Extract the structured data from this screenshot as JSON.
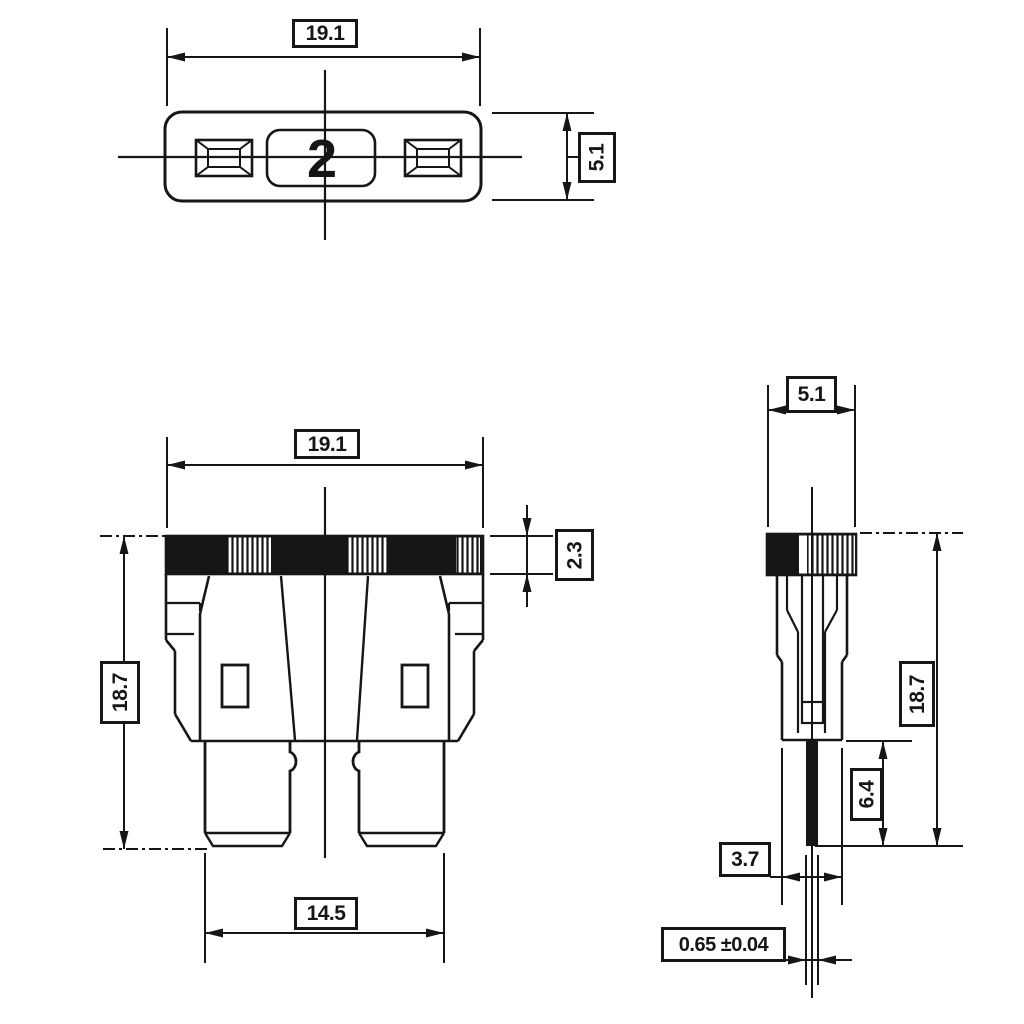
{
  "colors": {
    "background": "#ffffff",
    "ink": "#161616"
  },
  "views": {
    "top_view": {
      "marking": "2"
    },
    "front_view": {},
    "side_view": {}
  },
  "labels": {
    "top_width": "19.1",
    "top_height": "5.1",
    "front_width": "19.1",
    "front_cap_height": "2.3",
    "front_height": "18.7",
    "front_terminal_span": "14.5",
    "side_width": "5.1",
    "side_height": "18.7",
    "side_terminal_length": "6.4",
    "side_base_width": "3.7",
    "side_terminal_thickness": "0.65 ±0.04"
  }
}
